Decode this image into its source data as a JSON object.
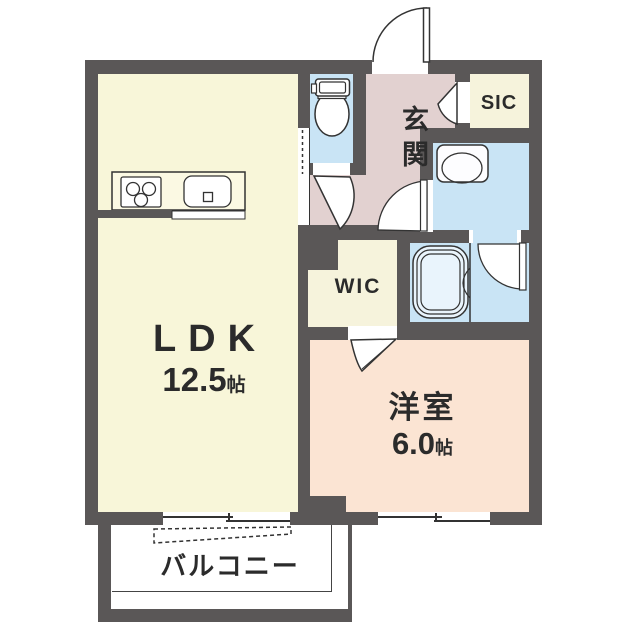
{
  "plan_title": "1LDK floor plan",
  "rooms": {
    "ldk": {
      "name": "LDK",
      "area_value": "12.5",
      "area_unit": "帖"
    },
    "western_room": {
      "name": "洋室",
      "area_value": "6.0",
      "area_unit": "帖"
    },
    "entrance": {
      "name": "玄関"
    },
    "shoe_closet": {
      "name": "SIC"
    },
    "walk_in_closet": {
      "name": "WIC"
    },
    "balcony": {
      "name": "バルコニー"
    }
  },
  "fixtures": [
    "toilet-icon",
    "washbasin-icon",
    "bathtub-icon",
    "stove-icon",
    "kitchen-sink-icon"
  ],
  "doors": [
    "entrance-door",
    "sic-door",
    "toilet-door",
    "washroom-door",
    "bath-door",
    "wic-door",
    "ldk-sliding-door"
  ],
  "windows": [
    "ldk-balcony-window",
    "western-room-window"
  ],
  "colors": {
    "wall": "#5a5757",
    "ldk": "#f8f6d9",
    "western_room": "#fbe4d3",
    "entrance_hall": "#e2d1d0",
    "wet_area": "#c9e4f5",
    "closet": "#f6f3dc",
    "balcony": "#ffffff"
  }
}
